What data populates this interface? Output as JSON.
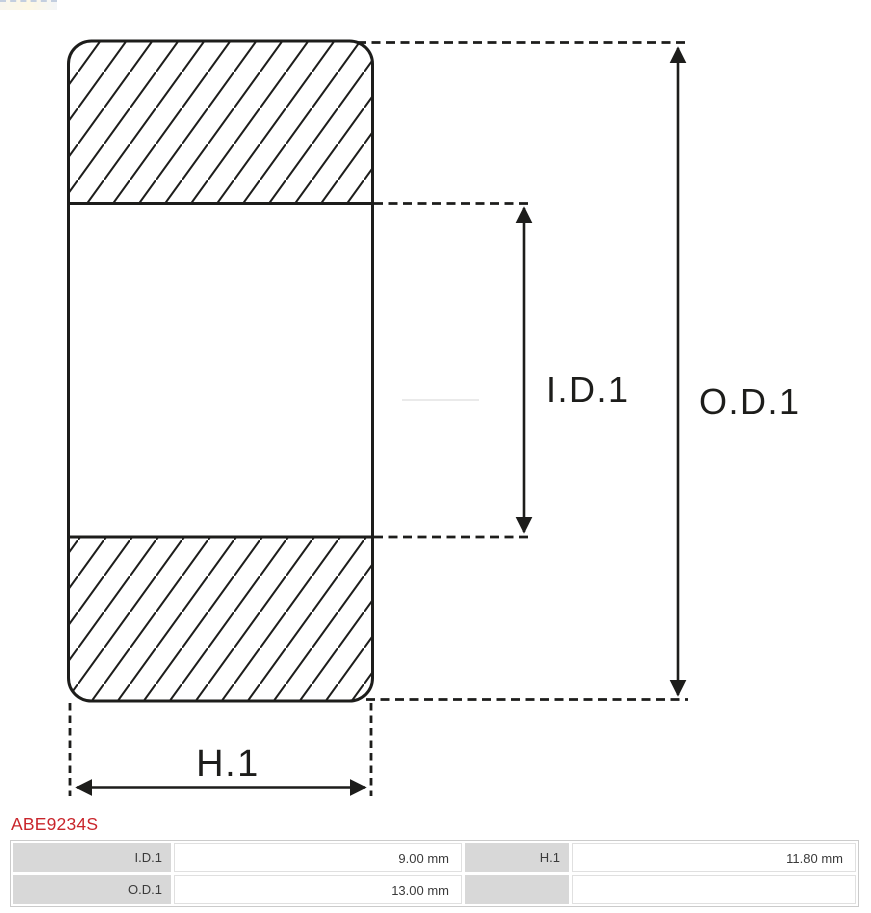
{
  "part": {
    "code": "ABE9234S"
  },
  "diagram": {
    "labels": {
      "inner_diameter": "I.D.1",
      "outer_diameter": "O.D.1",
      "height": "H.1"
    }
  },
  "spec_table": {
    "rows": [
      {
        "label1": "I.D.1",
        "value1": "9.00 mm",
        "label2": "H.1",
        "value2": "11.80 mm"
      },
      {
        "label1": "O.D.1",
        "value1": "13.00 mm",
        "label2": "",
        "value2": ""
      }
    ]
  },
  "colors": {
    "accent_red": "#c9252b",
    "drawing_line": "#1d1d1b",
    "table_label_bg": "#d8d8d8",
    "table_border": "#cbcbcb"
  }
}
